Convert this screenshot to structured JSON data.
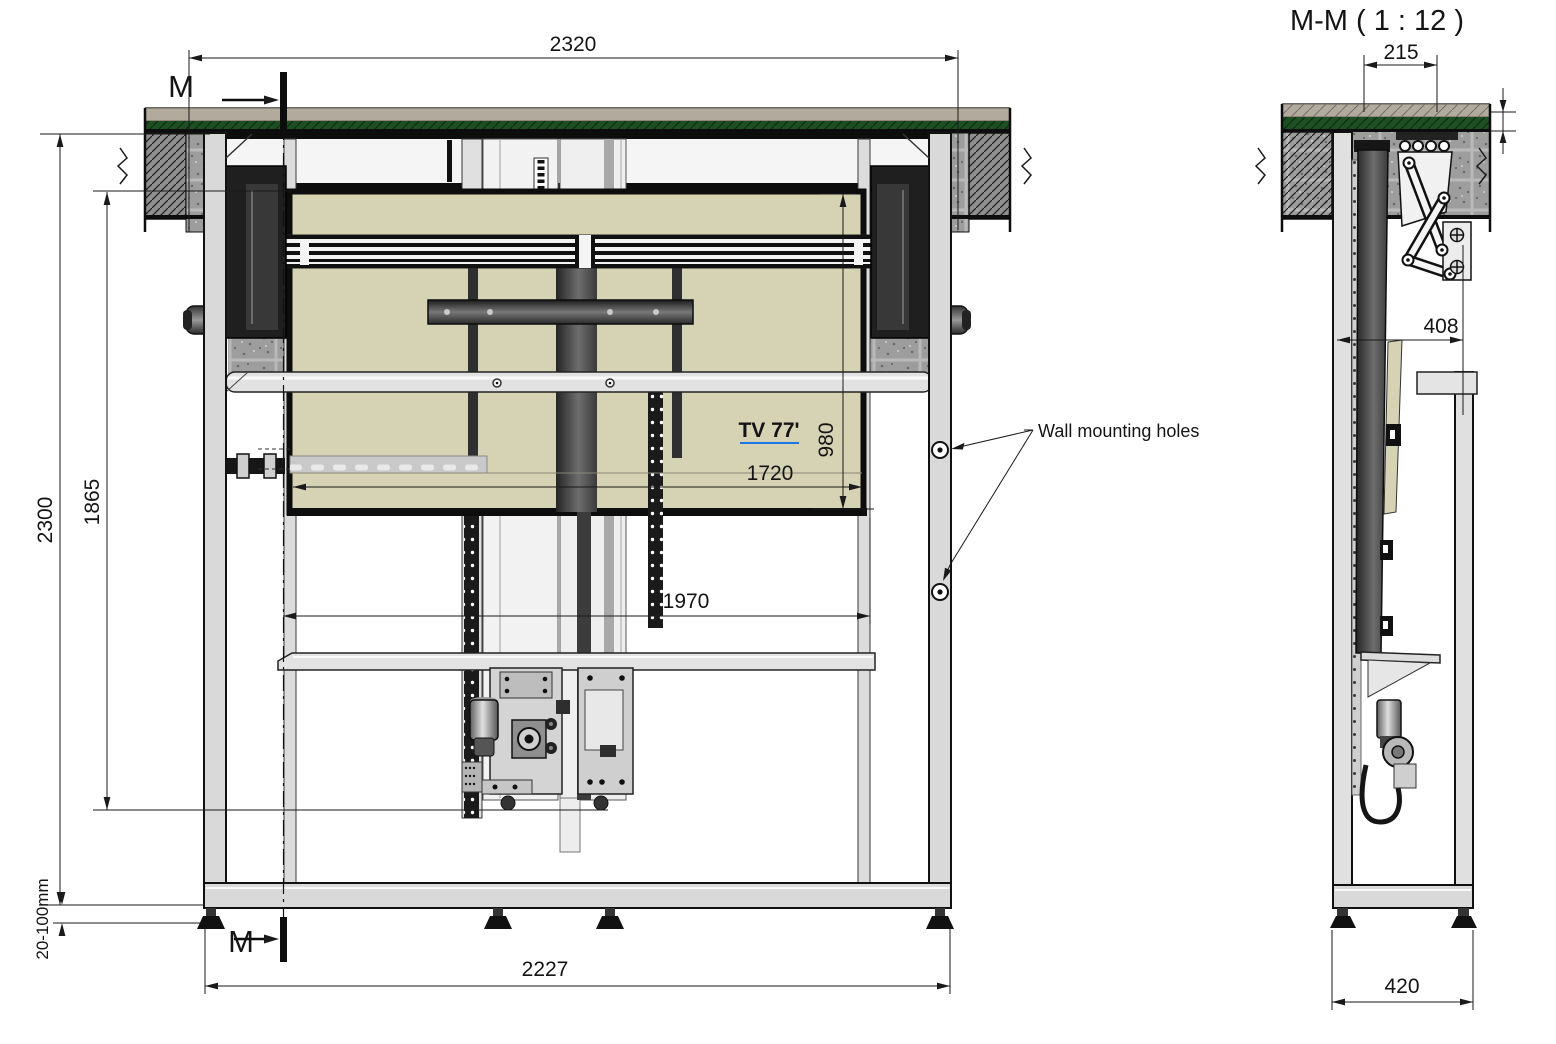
{
  "labels": {
    "section_title": "M-M ( 1 : 12 )",
    "section_marker_top": "M",
    "section_marker_bottom": "M",
    "tv_label": "TV 77'",
    "wall_mounting": "Wall mounting holes"
  },
  "front_view": {
    "dimensions": {
      "opening_width": "2320",
      "overall_height": "2300",
      "lift_travel_height": "1865",
      "foot_adjustment": "20-100mm",
      "frame_width": "2227",
      "tv_width": "1720",
      "tv_height": "980",
      "inner_span": "1970"
    }
  },
  "section_view": {
    "dimensions": {
      "recess_depth": "215",
      "unit_depth": "408",
      "base_depth": "420"
    }
  },
  "colors": {
    "tv_label_blue": "#1b74e8",
    "ceiling_green": "#1c5023",
    "ceiling_band": "#b2aa9c",
    "tv_beige": "#d6d2b4",
    "line_black": "#111111"
  }
}
